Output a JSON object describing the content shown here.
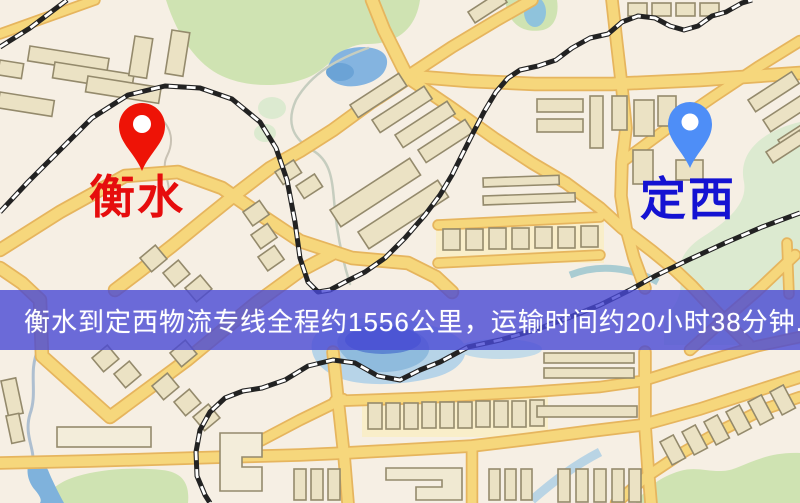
{
  "map": {
    "origin": {
      "label": "衡水",
      "pin_color": "#ee1306",
      "label_color": "#e60d0d"
    },
    "destination": {
      "label": "定西",
      "pin_color": "#4e8ef7",
      "label_color": "#1412d2"
    }
  },
  "banner": {
    "text": "衡水到定西物流专线全程约1556公里，运输时间约20小时38分钟.",
    "background": "#4949d5",
    "text_color": "#ffffff"
  },
  "colors": {
    "map_background": "#f6efe4",
    "road_fill": "#f6d77c",
    "road_casing": "#e6b55e",
    "building_fill": "#ebe2c4",
    "building_stroke": "#948a6c",
    "green_area": "#cfe3b2",
    "green_area_pale": "#dcead0",
    "water": "#84b4e0",
    "lake_pale": "#b7d4e8",
    "railway": "#222222"
  }
}
